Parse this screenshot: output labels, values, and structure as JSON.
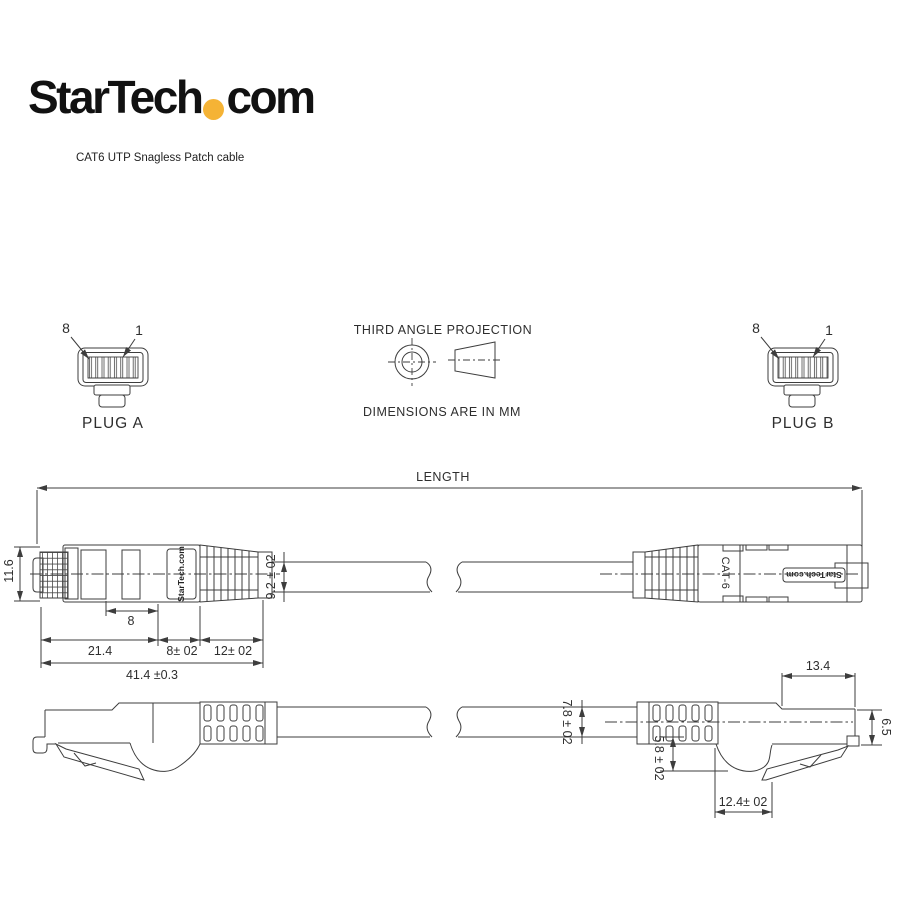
{
  "logo": {
    "text_main": "StarTech",
    "text_suffix": "com"
  },
  "subtitle": "CAT6 UTP Snagless Patch cable",
  "projection": {
    "title": "THIRD ANGLE PROJECTION",
    "units_note": "DIMENSIONS ARE IN MM"
  },
  "plug_a": {
    "pin_8": "8",
    "pin_1": "1",
    "label": "PLUG A"
  },
  "plug_b": {
    "pin_8": "8",
    "pin_1": "1",
    "label": "PLUG B"
  },
  "markings": {
    "brand_left": "StarTech.com",
    "brand_right": "StarTech.com",
    "category": "CAT-6"
  },
  "dims": {
    "length": "LENGTH",
    "plug_width": "11.6",
    "contact_length": "8",
    "body_length": "21.4",
    "segment_8": "8± 02",
    "segment_12": "12± 02",
    "overall_length": "41.4 ±0.3",
    "boot_diameter": "9.2 ± 02",
    "cable_diameter": "7.8 ± 02",
    "head_length": "13.4",
    "head_height": "6.5",
    "bell_height": "5.8 ± 02",
    "bell_length": "12.4± 02"
  },
  "colors": {
    "line": "#3d3d3d",
    "accent_dot": "#F5B335"
  }
}
